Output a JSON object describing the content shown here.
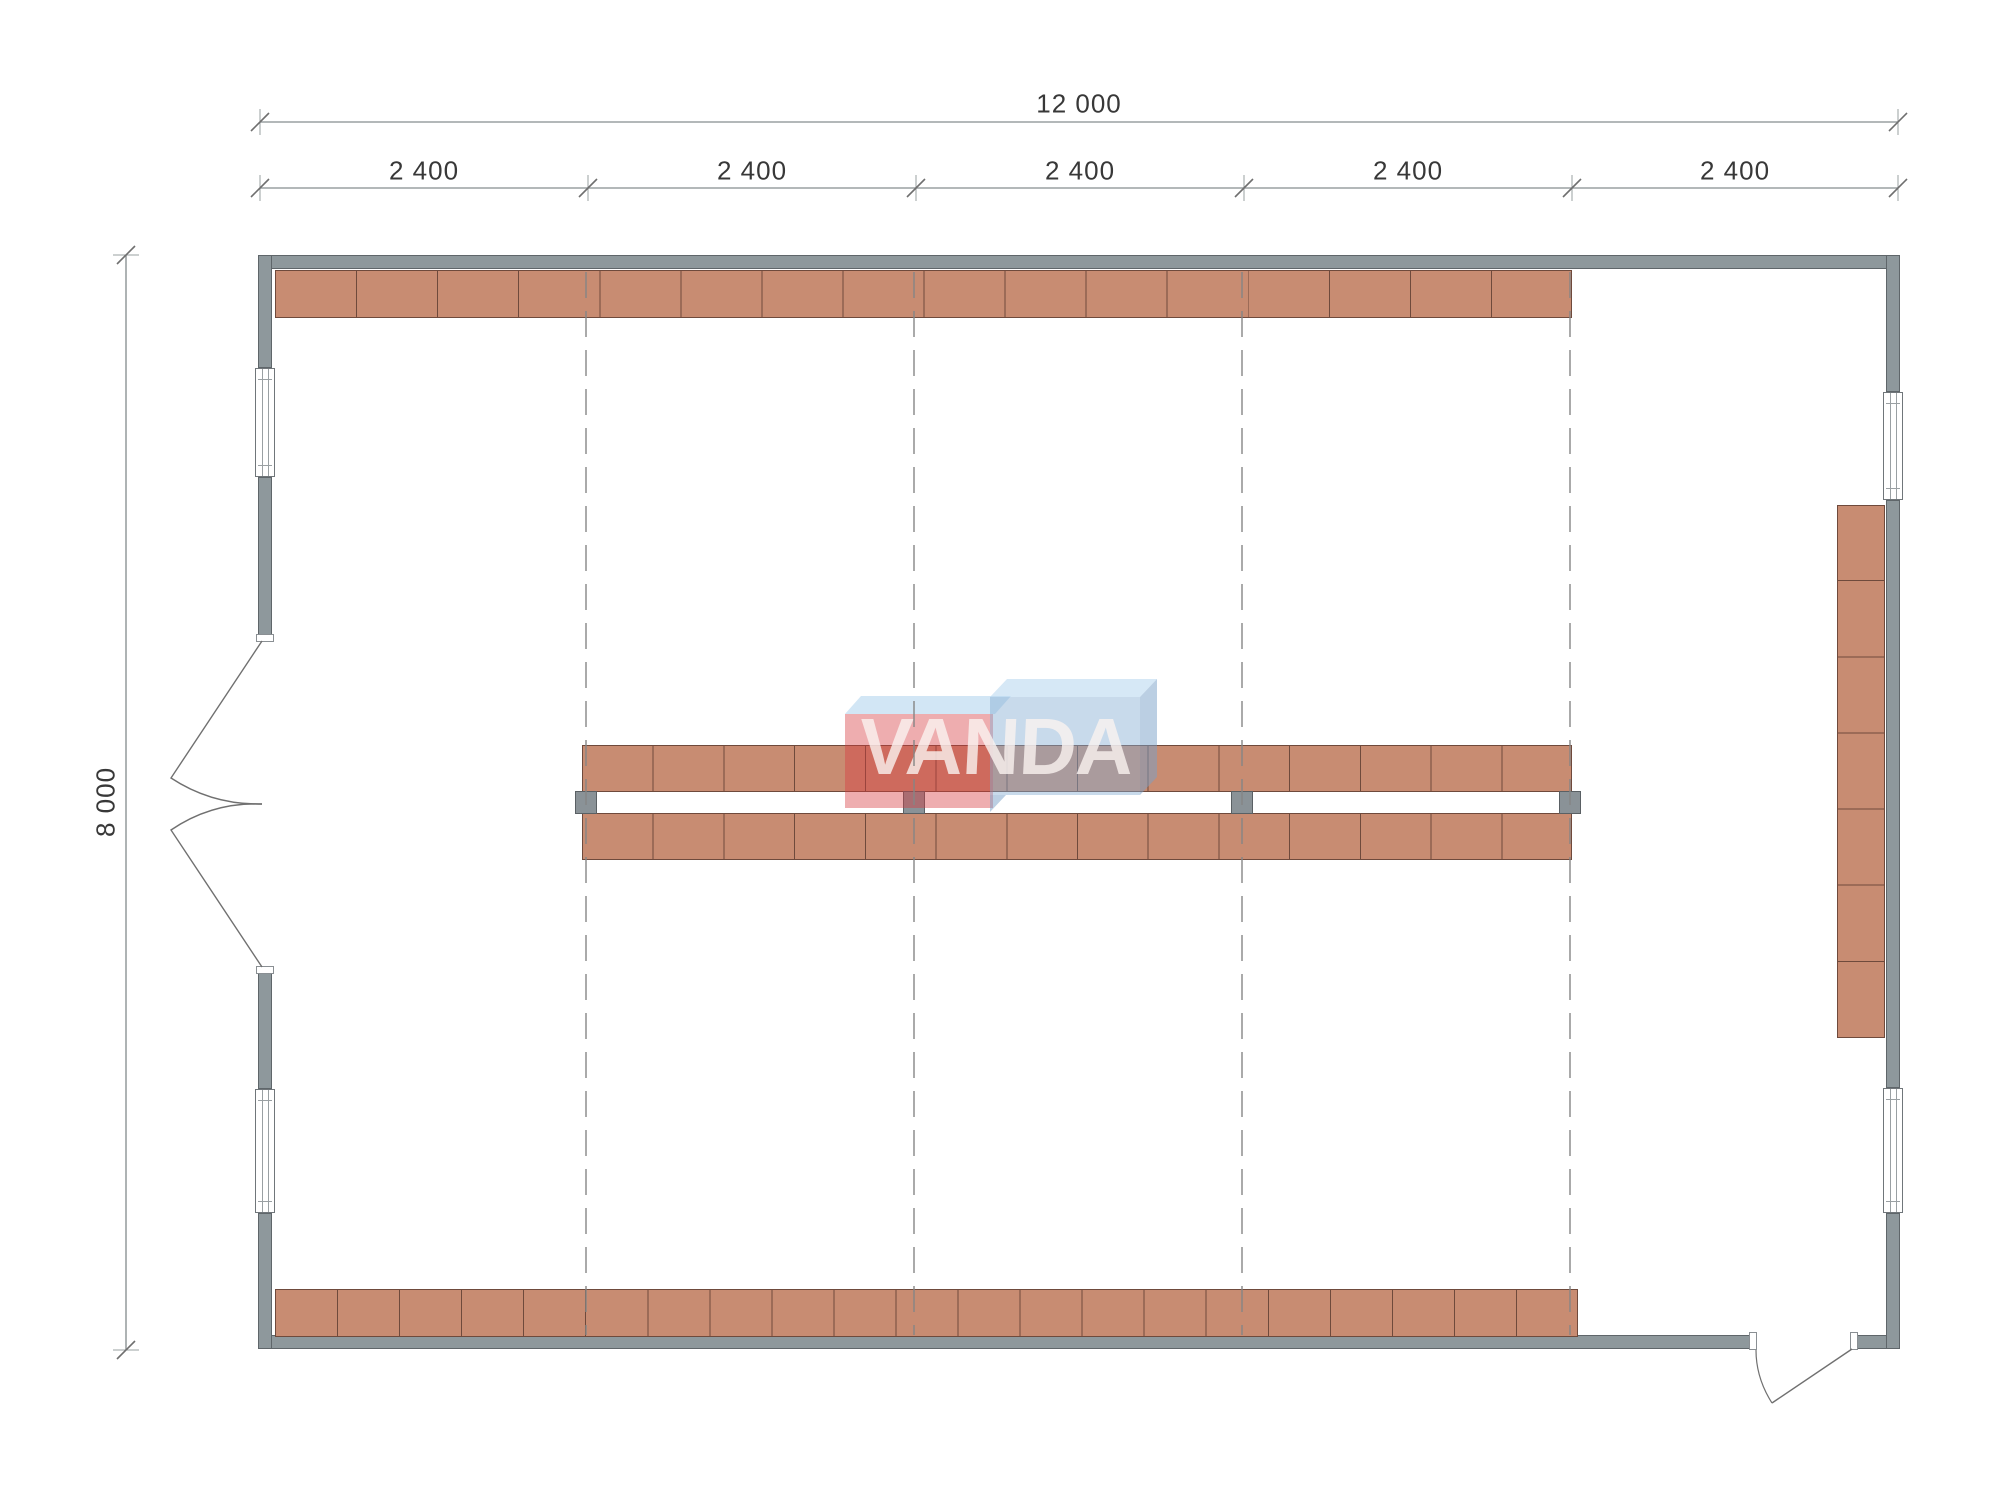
{
  "drawing": {
    "type": "floor-plan",
    "dimensions": {
      "overall_width": {
        "label": "12 000"
      },
      "overall_height": {
        "label": "8 000"
      },
      "segments": [
        {
          "label": "2 400"
        },
        {
          "label": "2 400"
        },
        {
          "label": "2 400"
        },
        {
          "label": "2 400"
        },
        {
          "label": "2 400"
        }
      ]
    },
    "watermark": {
      "brand": "VANDA"
    },
    "colors": {
      "wall": "#8e989c",
      "wall_outline": "#5f666a",
      "shelf": "#c88c72",
      "shelf_outline": "#6f4a3c",
      "post": "#8a9297",
      "grid_line": "#858585",
      "dim_line": "#9aa0a2",
      "dim_tick": "#6f6f6f",
      "dim_text": "#383838",
      "door_line": "#707070",
      "watermark_red_front": "rgba(214,60,64,0.42)",
      "watermark_red_top": "rgba(165,205,235,0.50)",
      "watermark_blue_front": "rgba(132,172,210,0.45)",
      "watermark_blue_top": "rgba(180,214,238,0.55)",
      "watermark_blue_side": "rgba(120,160,200,0.50)",
      "watermark_text": "rgba(250,243,240,0.80)"
    }
  }
}
